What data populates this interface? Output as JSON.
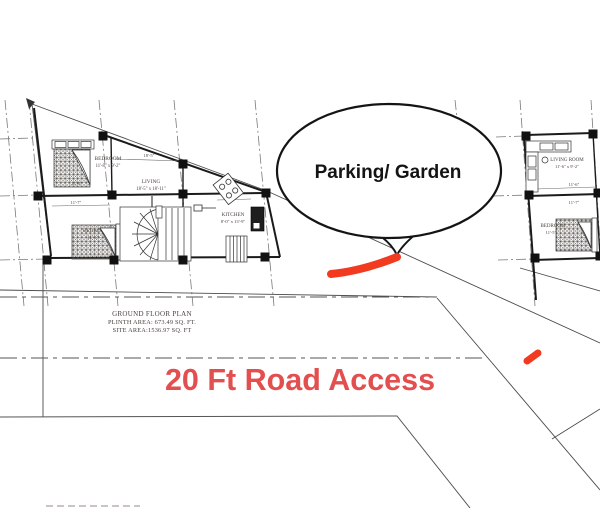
{
  "speech_bubble": {
    "label": "Parking/ Garden"
  },
  "road_label": {
    "text": "20 Ft Road Access",
    "color": "#e34f4f"
  },
  "title_block": {
    "line1": "GROUND FLOOR PLAN",
    "line2": "PLINTH AREA: 673.49 SQ. FT.",
    "line3": "SITE AREA:1536.97 SQ. FT"
  },
  "left_plan": {
    "bedroom_top_name": "BEDROOM",
    "bedroom_top_dims": "11'-8\" x 9'-2\"",
    "living_name": "LIVING",
    "living_dims": "18'-5\" x 18'-11\"",
    "kitchen_name": "KITCHEN",
    "kitchen_dims": "8'-0\" x 13'-9\"",
    "bath_name": "C. BATH",
    "bath_dims": "8'-0\" x 8'-0\"",
    "bedroom_bottom_name": "BEDROOM",
    "bedroom_bottom_dims": "11'-5\"",
    "dim_living_width": "18'-5\"",
    "dim_bedroom_width": "11'-8\"",
    "dim_row_width": "11'-7\"",
    "dim_kitchen_top": "8'-2\""
  },
  "right_plan": {
    "living_room_name": "LIVING ROOM",
    "living_room_dims": "11'-6\" x 9'-2\"",
    "bedroom_name": "BEDROOM",
    "bedroom_dims": "11'-5\"",
    "dim_w1": "11'-6\"",
    "dim_w2": "11'-7\""
  },
  "markers": {
    "color": "#f13a1f"
  }
}
